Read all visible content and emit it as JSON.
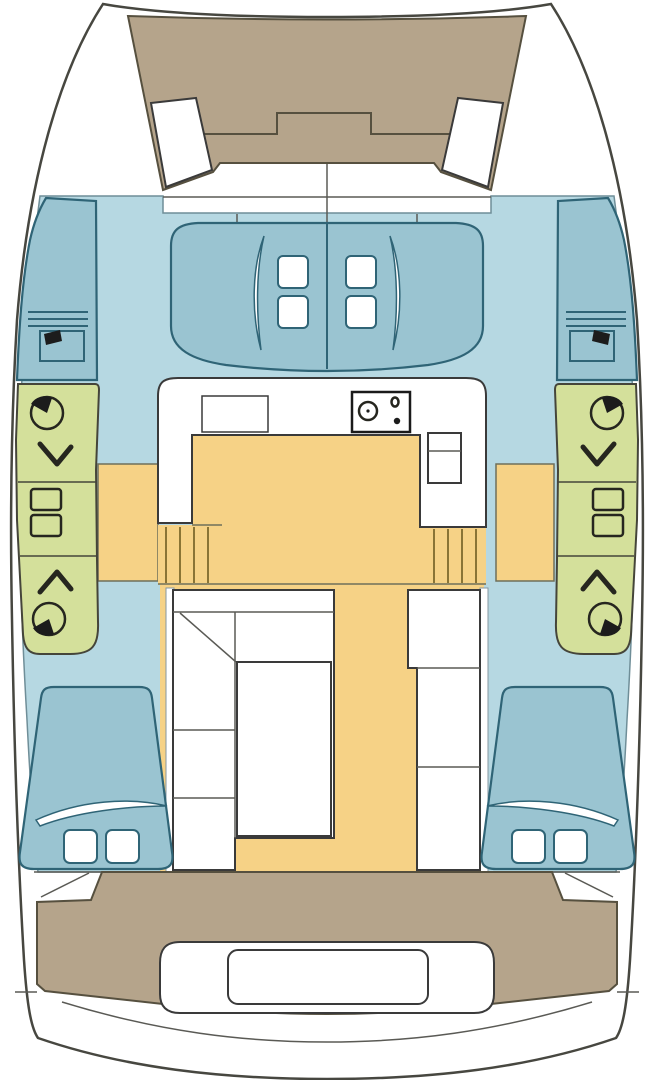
{
  "diagram": {
    "type": "boat-floor-plan",
    "vessel": "catamaran",
    "view": "top-down interior layout",
    "text_labels": []
  },
  "colors": {
    "background": "#ffffff",
    "hull_fill": "#ffffff",
    "outline": "#474740",
    "deck_tan": "#b5a48b",
    "deck_tan_line": "#56503f",
    "cabin_blue": "#b6d8e2",
    "cabin_blue_line": "#6f8e98",
    "bed_blue": "#9ac4d1",
    "bed_outline": "#2f6476",
    "head_green": "#d4e09b",
    "head_line": "#45453a",
    "floor_yellow": "#f6d286",
    "floor_line": "#6f6f5a",
    "step_line": "#8a7435",
    "furniture_white": "#ffffff",
    "furniture_line": "#3a3a3a",
    "fixture_line": "#26261f",
    "toilet_black": "#1c1c1c",
    "detail_line": "#5a5a55",
    "wall_line": "#8697a0"
  },
  "areas": {
    "foredeck": "tan trampoline and anchor locker deck between bows",
    "bow_seats": "two angled white seats on foredeck",
    "forward_cabins": "blue area with two double berths and pillows",
    "port_head": "green bathroom block with two toilets, two showers, two sinks",
    "starboard_head": "green bathroom block with two toilets, two showers, two sinks",
    "galley": "white U-shaped counter with stove, cabinet and double sink",
    "companionway_steps": "yellow stair treads down into each hull",
    "salon": "yellow floor with dinette seating, table and starboard unit",
    "aft_cabins": "port and starboard double berths with pillows",
    "cockpit": "tan aft deck with bench seat and transom steps"
  },
  "icons": {
    "toilet": "circle-with-black-seat-wedge",
    "shower": "chevron-arrow",
    "sink": "rounded-rectangle-basin",
    "stove": "two-burner-cooktop",
    "galley_sink": "double-basin-rectangle"
  }
}
